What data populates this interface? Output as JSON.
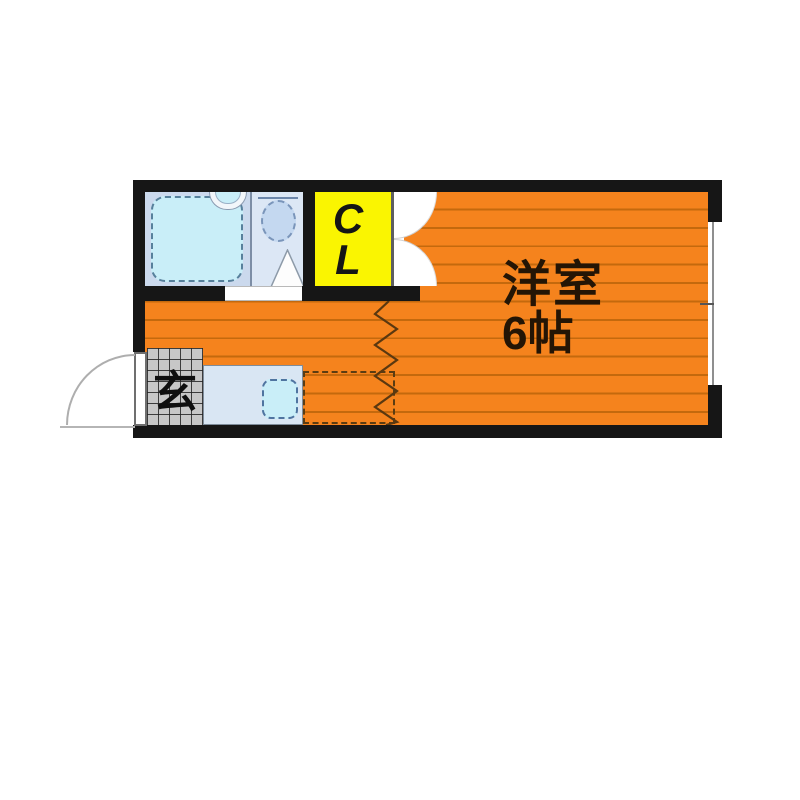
{
  "floorplan": {
    "main_room": {
      "name": "洋室",
      "size": "6帖"
    },
    "closet": {
      "letters": [
        "C",
        "L"
      ]
    },
    "entrance": {
      "label": "玄"
    },
    "fixtures": [
      "bathtub",
      "washbasin",
      "toilet",
      "shower-triangle",
      "kitchen-sink",
      "kitchen-counter",
      "appliance-space",
      "closet-double-door",
      "entry-door",
      "window",
      "zigzag-partition",
      "entrance-tile-floor"
    ],
    "colors": {
      "wall": "#161616",
      "floor_orange": "#f5831d",
      "floor_line": "#c4690d",
      "closet_yellow": "#faf501",
      "bath_bg": "#cbd9ed",
      "toilet_bg": "#dce7f5",
      "fixture_cyan": "#c9eef8",
      "fixture_blue": "#c4d8f0",
      "counter_blue": "#d9e6f3",
      "tile_gray": "#c7c7c7",
      "text_dark": "#241505"
    }
  }
}
